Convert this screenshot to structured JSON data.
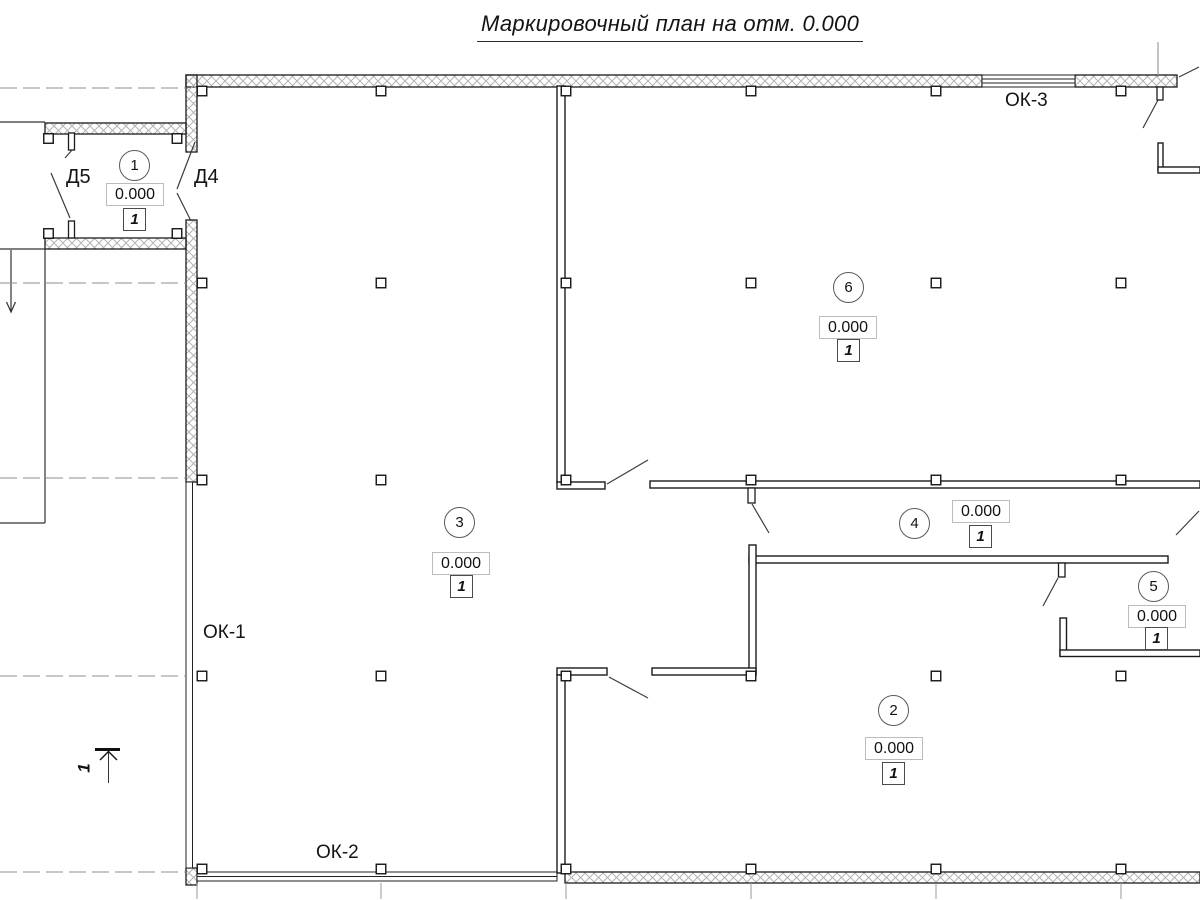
{
  "title": "Маркировочный план на отм. 0.000",
  "rooms": [
    {
      "number": "1",
      "elevation": "0.000",
      "type_mark": "1"
    },
    {
      "number": "2",
      "elevation": "0.000",
      "type_mark": "1"
    },
    {
      "number": "3",
      "elevation": "0.000",
      "type_mark": "1"
    },
    {
      "number": "4",
      "elevation": "0.000",
      "type_mark": "1"
    },
    {
      "number": "5",
      "elevation": "0.000",
      "type_mark": "1"
    },
    {
      "number": "6",
      "elevation": "0.000",
      "type_mark": "1"
    }
  ],
  "window_labels": {
    "ok1": "ОК-1",
    "ok2": "ОК-2",
    "ok3": "ОК-3"
  },
  "door_labels": {
    "d4": "Д4",
    "d5": "Д5"
  },
  "section_mark": {
    "label": "1"
  }
}
